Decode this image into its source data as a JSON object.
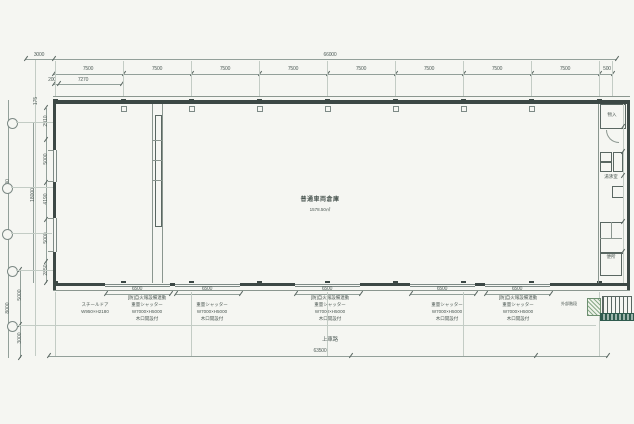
{
  "drawing": {
    "type": "floor-plan",
    "room": {
      "name": "普通車両倉庫",
      "area": "1578.50㎡"
    },
    "site_road_label": "上車路"
  },
  "dims": {
    "site_left": "3000",
    "overall_top": "66000",
    "top_bays": [
      "7500",
      "7500",
      "7500",
      "7500",
      "7500",
      "7500",
      "7500",
      "7500"
    ],
    "top_right_end": "500",
    "sub_200": "200",
    "sub_7270": "7270",
    "left_175": "175",
    "left_chain": [
      "2910",
      "5000",
      "4190",
      "5000",
      "2850"
    ],
    "left_18000": "18000",
    "left_22300": "22300",
    "left_lower_5000": "5000",
    "left_lower_3000": "3000",
    "left_lower_8000": "8000",
    "openings": [
      "6500",
      "6500",
      "6500",
      "6500",
      "6500"
    ],
    "overall_bottom": "63500"
  },
  "annotations": {
    "steel_door": {
      "l1": "スチールドア",
      "l2": "W950×H2180"
    },
    "shutter_fire": {
      "l1": "[防]自火報設備連動",
      "l2": "重量シャッター",
      "l3": "W7000×H5000",
      "l4": "木口開設付"
    },
    "shutter": {
      "l1": "重量シャッター",
      "l2": "W7000×H5000",
      "l3": "木口開設付"
    },
    "stair_note": "外部階段",
    "right_rooms": {
      "top": "物入",
      "mid": "湯沸室",
      "wc": "便所"
    }
  }
}
